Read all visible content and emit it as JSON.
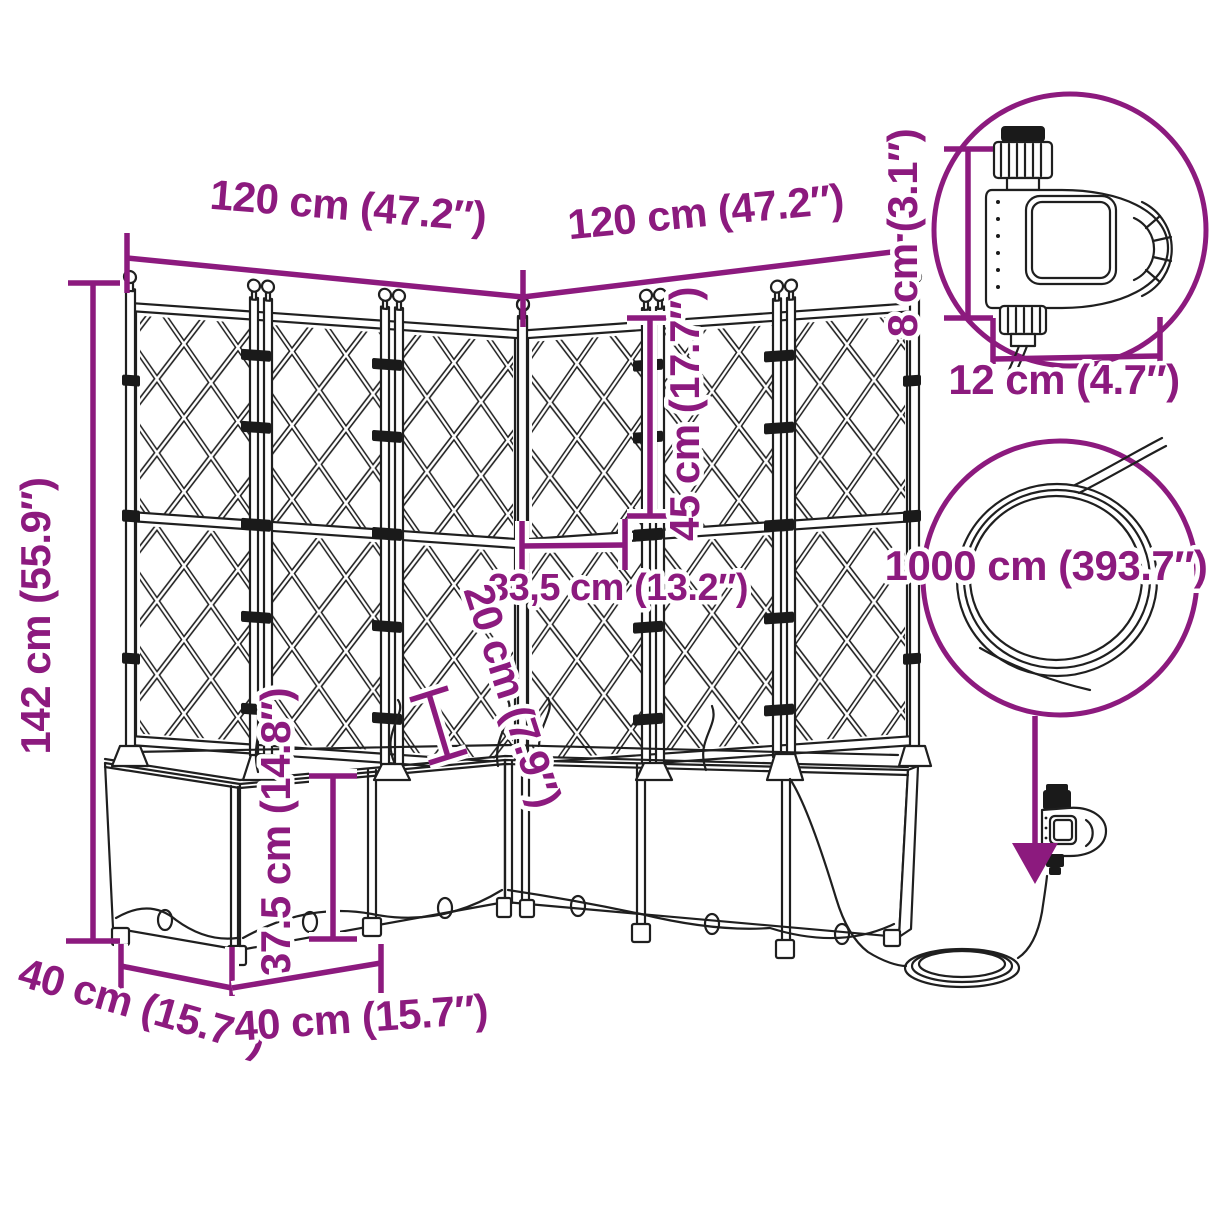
{
  "title": "Corner garden planter with trellis and automatic watering set — dimension diagram",
  "colors": {
    "dimension": "#8c1a7e",
    "line_art": "#1f1f1f",
    "background": "#ffffff"
  },
  "labels": {
    "wall_left_width": "120 cm (47.2″)",
    "wall_right_width": "120 cm (47.2″)",
    "total_height": "142 cm (55.9″)",
    "trellis_section_height": "45 cm (17.7″)",
    "corner_section_width": "33,5 cm (13.2″)",
    "clearance": "20 cm (7.9″)",
    "planter_box_height": "37.5 cm (14.8″)",
    "depth_left": "40 cm (15.7″)",
    "depth_front": "40 cm (15.7″)",
    "timer_height": "8 cm (3.1″)",
    "timer_width": "12 cm (4.7″)",
    "hose_length": "1000 cm (393.7″)"
  }
}
